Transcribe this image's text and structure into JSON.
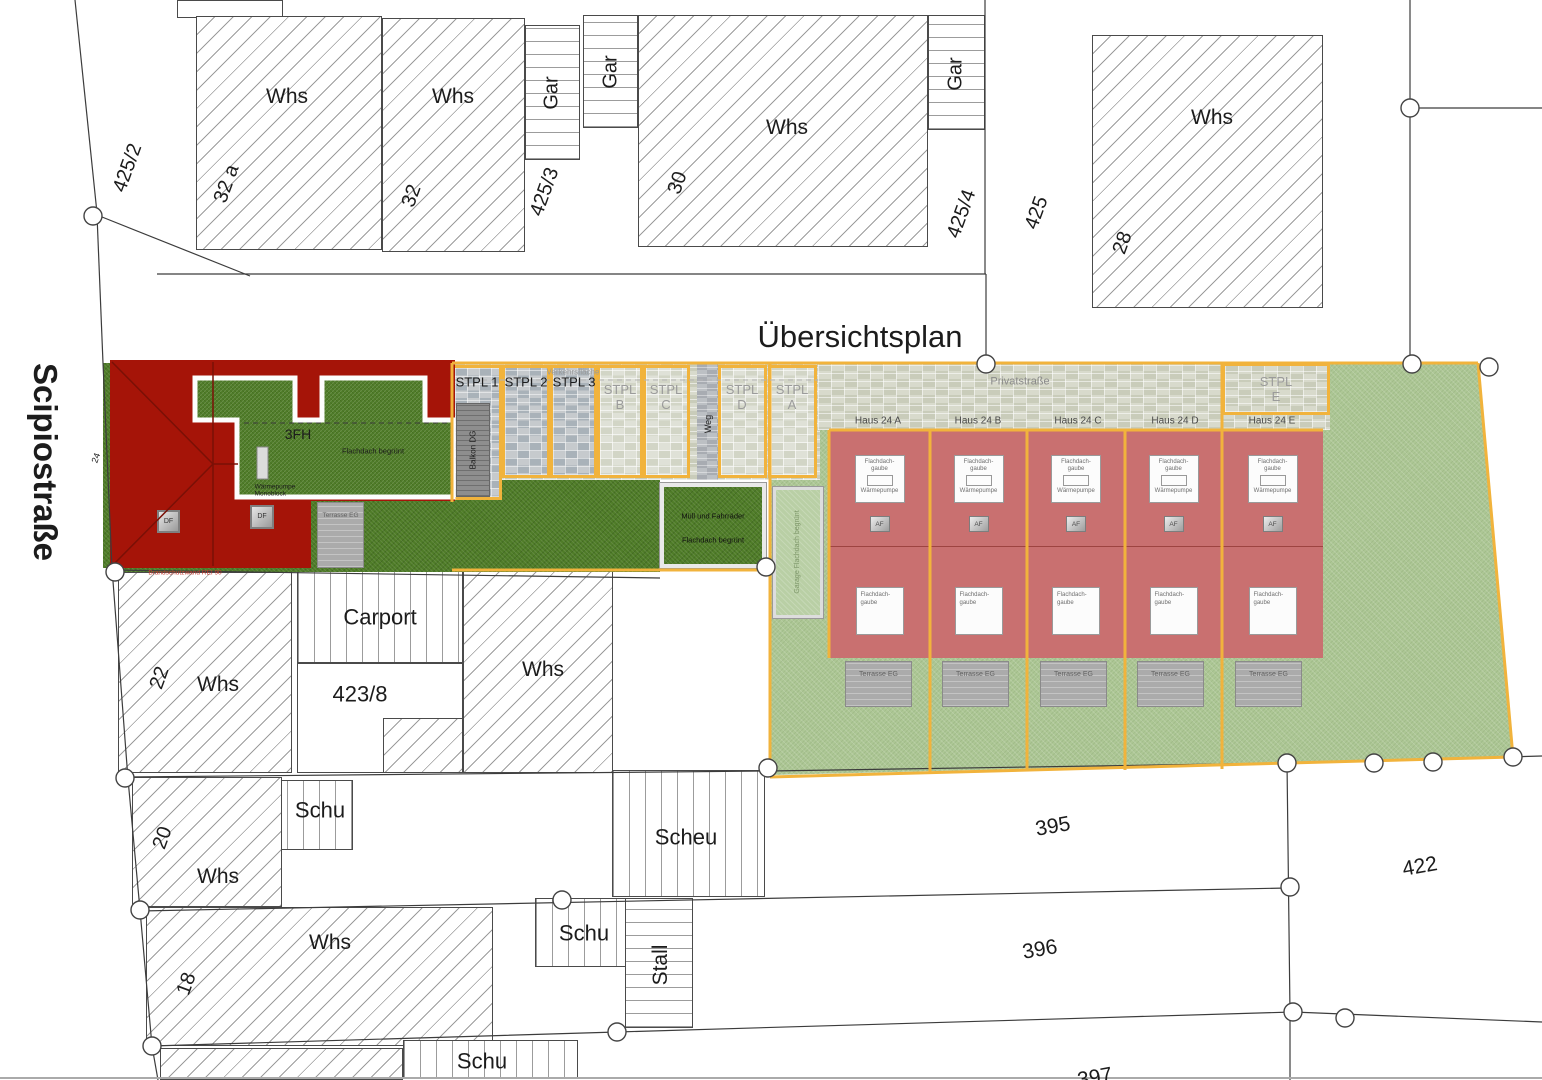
{
  "title": "Übersichtsplan",
  "street": "Scipiostraße",
  "shared": {
    "whs": "Whs",
    "gar": "Gar",
    "schu": "Schu",
    "scheu": "Scheu",
    "stall": "Stall",
    "carport": "Carport"
  },
  "top": {
    "p425_2": "425/2",
    "p425_3": "425/3",
    "p425_4": "425/4",
    "p425": "425",
    "n32a": "32 a",
    "n32": "32",
    "n30": "30",
    "n28": "28"
  },
  "mid": {
    "n24": "24",
    "n22": "22",
    "plot": "423/8"
  },
  "bottom": {
    "n20": "20",
    "n18": "18",
    "p395": "395",
    "p396": "396",
    "p397": "397",
    "p422": "422"
  },
  "parking": {
    "verkehr": "Verkehrsfläche",
    "s1": "STPL 1",
    "s2": "STPL 2",
    "s3": "STPL 3",
    "w": "STPL",
    "lb": "B",
    "lc": "C",
    "ld": "D",
    "la": "A",
    "le": "E",
    "weg": "Weg",
    "balkon": "Balkon DG",
    "privat": "Privatstraße"
  },
  "building": {
    "fh": "3FH",
    "roof": "Flachdach begrünt",
    "hp1": "Wärmepumpe",
    "hp2": "Monoblock",
    "df": "DF",
    "terr": "Terrasse EG",
    "fire": "Brandschutzwand REI 90"
  },
  "waste": {
    "l1": "Müll und Fahrräder",
    "l2": "Flachdach begrünt"
  },
  "garage": {
    "label": "Garage Flachdach begrünt"
  },
  "houses": {
    "items": [
      {
        "name": "Haus 24 A"
      },
      {
        "name": "Haus 24 B"
      },
      {
        "name": "Haus 24 C"
      },
      {
        "name": "Haus 24 D"
      },
      {
        "name": "Haus 24 E"
      }
    ],
    "gaube1": "Flachdach-",
    "gaube2": "gaube",
    "hp": "Wärmepumpe",
    "af": "AF",
    "terr": "Terrasse EG"
  },
  "colors": {
    "boundary_orange": "#F1B33C",
    "building_red": "#A51408",
    "house_pink": "#C97070",
    "lawn_dark": "#4F7C28",
    "lawn_light": "#ADC795"
  }
}
